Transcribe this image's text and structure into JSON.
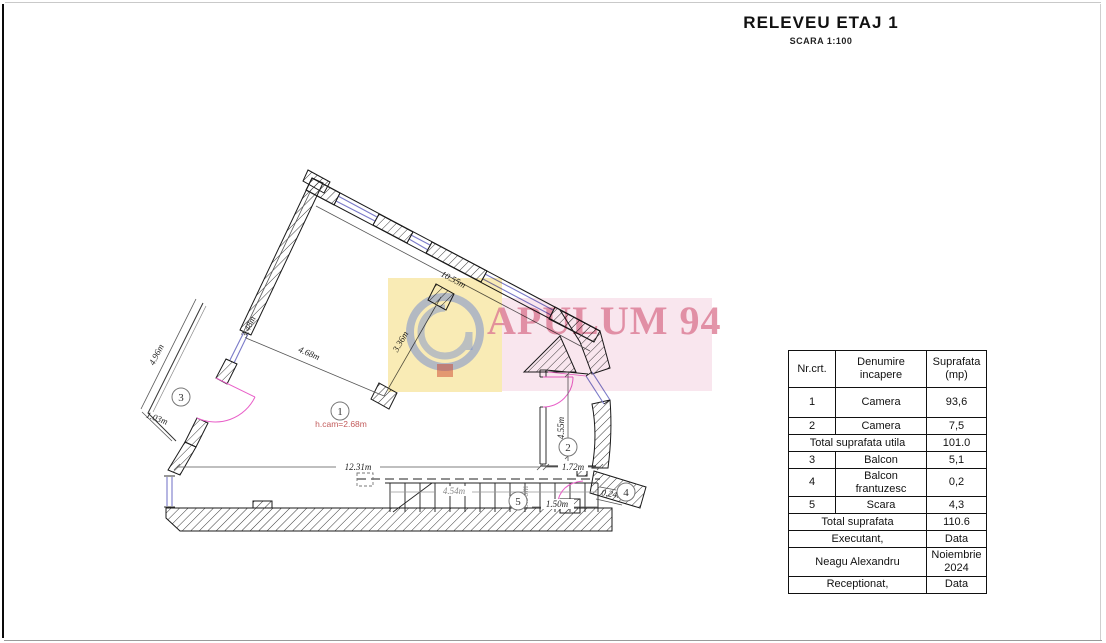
{
  "page": {
    "title": "RELEVEU ETAJ 1",
    "scale": "SCARA 1:100"
  },
  "watermark": {
    "text": "APULUM 94",
    "yellow": "#f4db78",
    "pink": "#f3cdde",
    "text_color": "#dc7a94"
  },
  "plan": {
    "rooms": {
      "r1": "1",
      "r2": "2",
      "r3": "3",
      "r4": "4",
      "r5": "5"
    },
    "dims": {
      "top_wall": "10.55m",
      "west_wall": "3.48m",
      "wall_to_pillar": "4.68m",
      "pillar_to_pillar": "3.36m",
      "balcony_length": "4.96m",
      "balcony_width": "1.03m",
      "room1_width": "12.31m",
      "room2_width": "1.72m",
      "room2_height": "4.55m",
      "bottom_right": "1.50m",
      "french_balcony": "0.24m",
      "stairs_length": "4.54m",
      "stairs_width": "0.96m",
      "ceiling": "h.cam=2.68m"
    },
    "colors": {
      "window": "#7b7bc9",
      "door": "#e85fc8",
      "note": "#c25b5b"
    }
  },
  "table": {
    "header": {
      "no": "Nr.crt.",
      "name1": "Denumire",
      "name2": "incapere",
      "area1": "Suprafata",
      "area2": "(mp)"
    },
    "rows": [
      {
        "no": "1",
        "name": "Camera",
        "area": "93,6"
      },
      {
        "no": "2",
        "name": "Camera",
        "area": "7,5"
      },
      {
        "no": "3",
        "name": "Balcon",
        "area": "5,1"
      },
      {
        "no": "4",
        "name": "Balcon frantuzesc",
        "area": "0,2"
      },
      {
        "no": "5",
        "name": "Scara",
        "area": "4,3"
      }
    ],
    "total_utila_label": "Total suprafata utila",
    "total_utila": "101.0",
    "total_label": "Total suprafata",
    "total": "110.6",
    "executant_label": "Executant,",
    "executant_data": "Data",
    "executant_name": "Neagu Alexandru",
    "executant_date": "Noiembrie 2024",
    "receptionat_label": "Receptionat,",
    "receptionat_data": "Data"
  }
}
